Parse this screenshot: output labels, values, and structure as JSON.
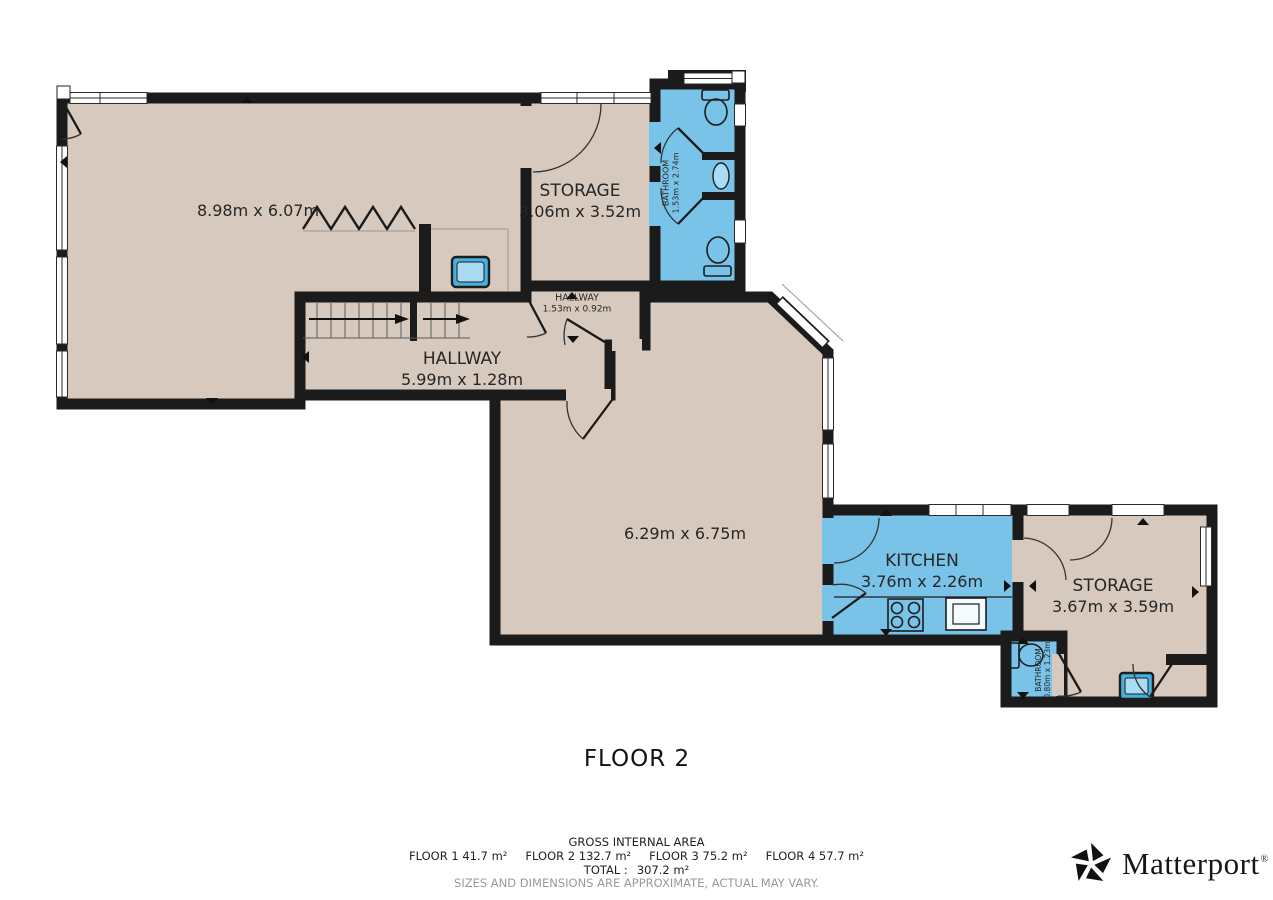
{
  "title": {
    "floor_label": "FLOOR 2"
  },
  "colors": {
    "floor_tan": "#d7c9bd",
    "wet_room_blue": "#79c3e8",
    "wall_black": "#1b1b1b",
    "fixture_blue": "#46b1e1",
    "fixture_blue_light": "#a9dcf4",
    "disclaimer_gray": "#9a9a9a"
  },
  "rooms": [
    {
      "name": "",
      "dims": "8.98m x 6.07m"
    },
    {
      "name": "STORAGE",
      "dims": "3.06m x 3.52m"
    },
    {
      "name": "BATHROOM",
      "dims": "1.53m x 2.74m"
    },
    {
      "name": "HALLWAY",
      "dims": "1.53m x 0.92m"
    },
    {
      "name": "HALLWAY",
      "dims": "5.99m x 1.28m"
    },
    {
      "name": "",
      "dims": "6.29m x 6.75m"
    },
    {
      "name": "KITCHEN",
      "dims": "3.76m x 2.26m"
    },
    {
      "name": "STORAGE",
      "dims": "3.67m x 3.59m"
    },
    {
      "name": "BATHROOM",
      "dims": "0.80m x 1.23m"
    }
  ],
  "footer": {
    "heading": "GROSS INTERNAL AREA",
    "floors": [
      {
        "label": "FLOOR 1",
        "area": "41.7 m²"
      },
      {
        "label": "FLOOR 2",
        "area": "132.7 m²"
      },
      {
        "label": "FLOOR 3",
        "area": "75.2 m²"
      },
      {
        "label": "FLOOR 4",
        "area": "57.7 m²"
      }
    ],
    "total_label": "TOTAL :",
    "total_value": "307.2 m²",
    "disclaimer": "SIZES AND DIMENSIONS ARE APPROXIMATE, ACTUAL MAY VARY."
  },
  "brand": {
    "name": "Matterport",
    "mark": "®"
  }
}
